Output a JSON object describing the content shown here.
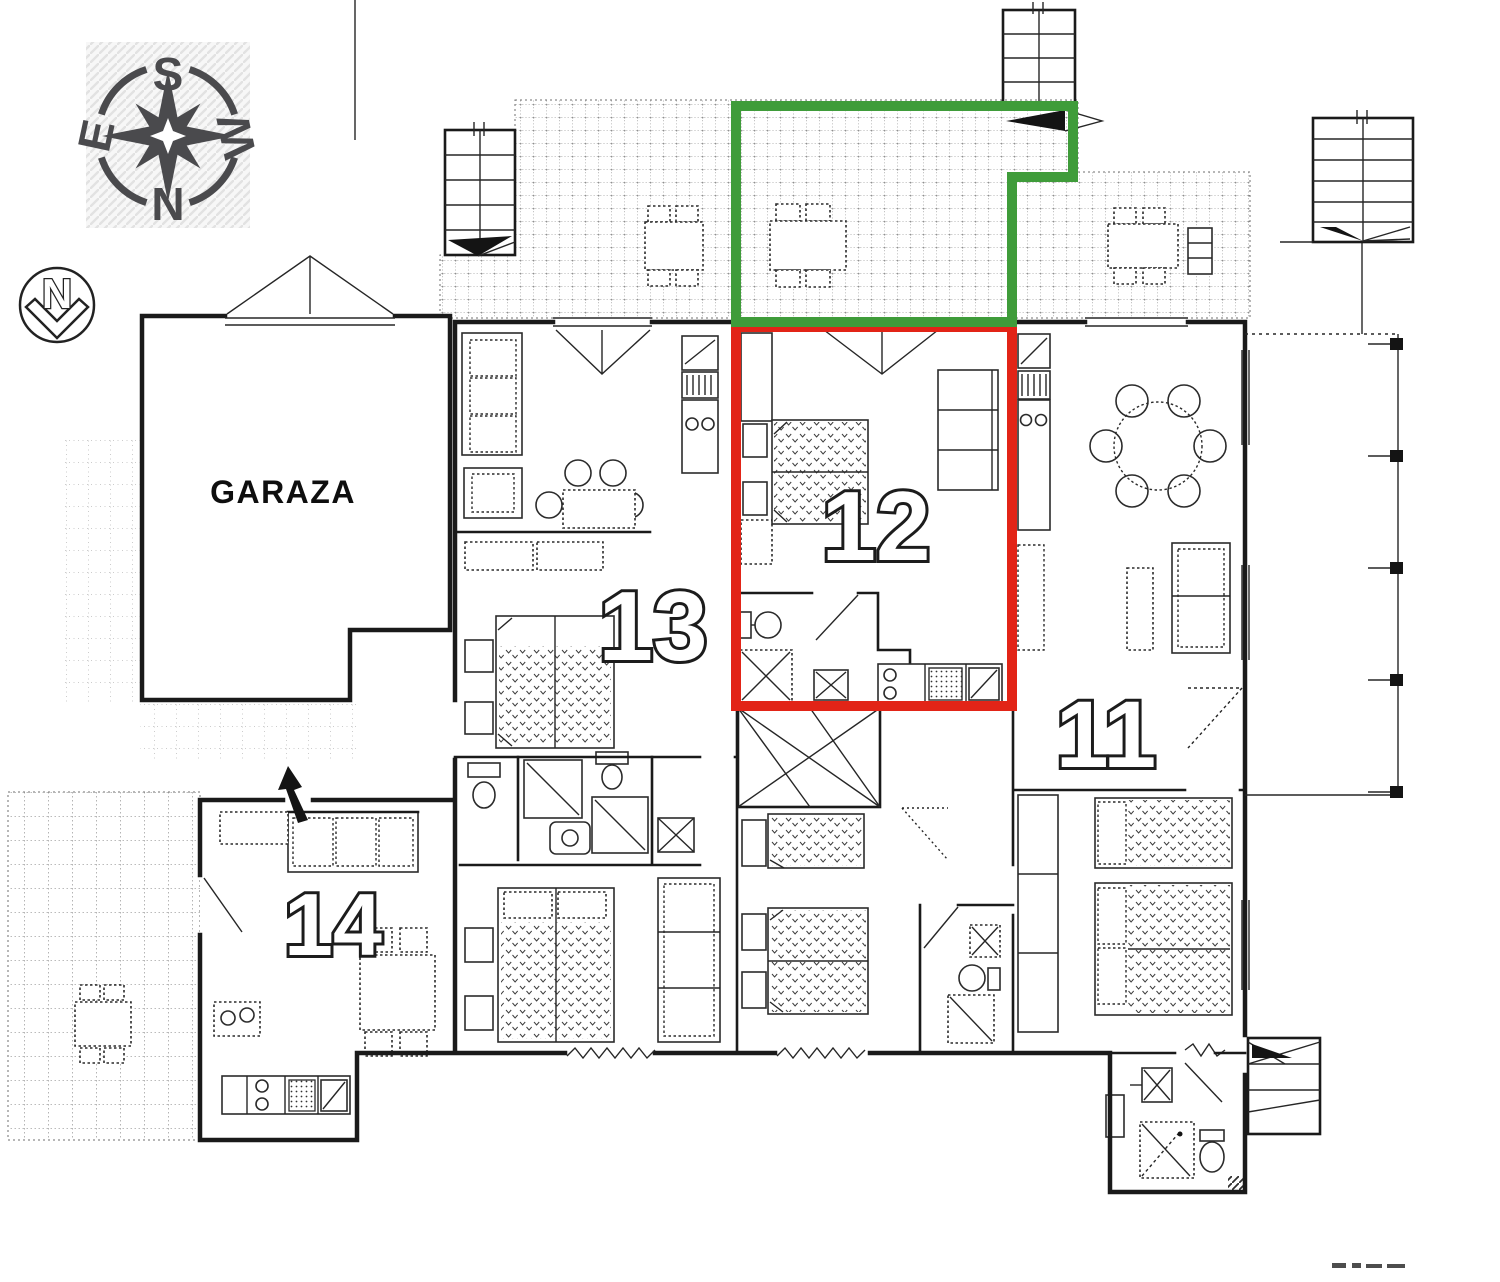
{
  "plan": {
    "garage_label": "GARAZA",
    "apartments": [
      {
        "number": "11"
      },
      {
        "number": "12",
        "highlighted": true
      },
      {
        "number": "13"
      },
      {
        "number": "14"
      }
    ]
  },
  "compass": {
    "top": "S",
    "bottom": "N",
    "left": "E",
    "right": "W"
  },
  "north_marker": {
    "label": "N"
  },
  "colors": {
    "apartment_12_outline": "#e22417",
    "apartment_12_terrace_outline": "#3f9c3a",
    "drawing_ink": "#1a1a1a",
    "compass_ink": "#4a4a4d"
  }
}
